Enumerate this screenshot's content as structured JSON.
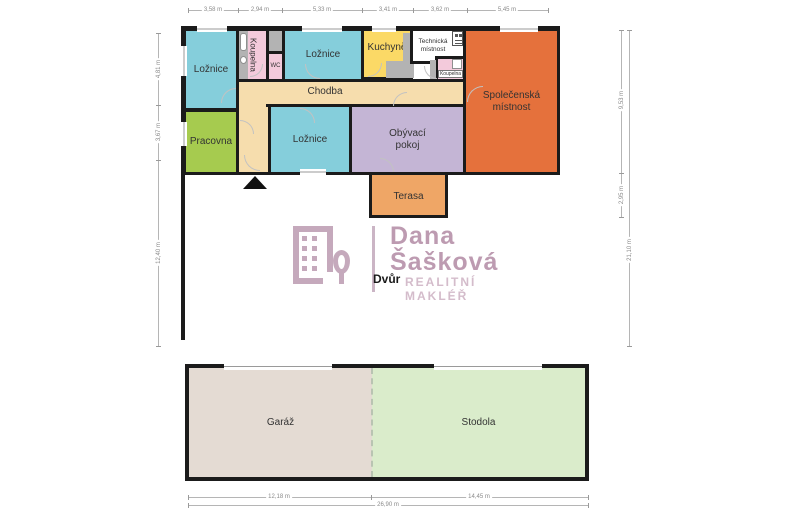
{
  "palette": {
    "wall": "#1b1b1b",
    "bedroom_cyan": "#85cedb",
    "bathroom_pink": "#f3cadb",
    "kitchen_yellow": "#fbd966",
    "hallway_tan": "#f6ddad",
    "study_green": "#a6cb4f",
    "living_lavender": "#c4b5d5",
    "common_orange": "#e5713c",
    "terrace_orange": "#efa666",
    "garage_beige": "#e4dbd3",
    "barn_green": "#daeccb",
    "fixture_grey": "#b3b3b3",
    "watermark_main": "#bd9bb1",
    "watermark_light": "#d4bccb"
  },
  "rooms": {
    "loznice1": {
      "label": "Ložnice"
    },
    "koupelna1": {
      "label": "Koupelna"
    },
    "wc": {
      "label": "WC"
    },
    "loznice2": {
      "label": "Ložnice"
    },
    "kuchyne": {
      "label": "Kuchyně"
    },
    "technicka": {
      "label": "Technická místnost"
    },
    "koupelna2": {
      "label": "Koupelna"
    },
    "spolecenska": {
      "label": "Společenská místnost"
    },
    "chodba": {
      "label": "Chodba"
    },
    "pracovna": {
      "label": "Pracovna"
    },
    "loznice3": {
      "label": "Ložnice"
    },
    "obyvaci": {
      "label": "Obývací pokoj"
    },
    "terasa": {
      "label": "Terasa"
    },
    "dvur": {
      "label": "Dvůr"
    },
    "garaz": {
      "label": "Garáž"
    },
    "stodola": {
      "label": "Stodola"
    }
  },
  "watermark": {
    "name_line1": "Dana",
    "name_line2": "Šašková",
    "tagline": "REALITNÍ MAKLÉŘ"
  },
  "dimensions": {
    "top": [
      "3,58 m",
      "2,94 m",
      "5,33 m",
      "3,41 m",
      "3,62 m",
      "5,45 m"
    ],
    "left": [
      "4,81 m",
      "3,67 m",
      "12,40 m"
    ],
    "right_inner": [
      "9,53 m",
      "2,95 m"
    ],
    "right_outer": [
      "21,10 m"
    ],
    "bottom_segments": [
      "12,18 m",
      "14,45 m"
    ],
    "bottom_total": [
      "26,90 m"
    ]
  }
}
